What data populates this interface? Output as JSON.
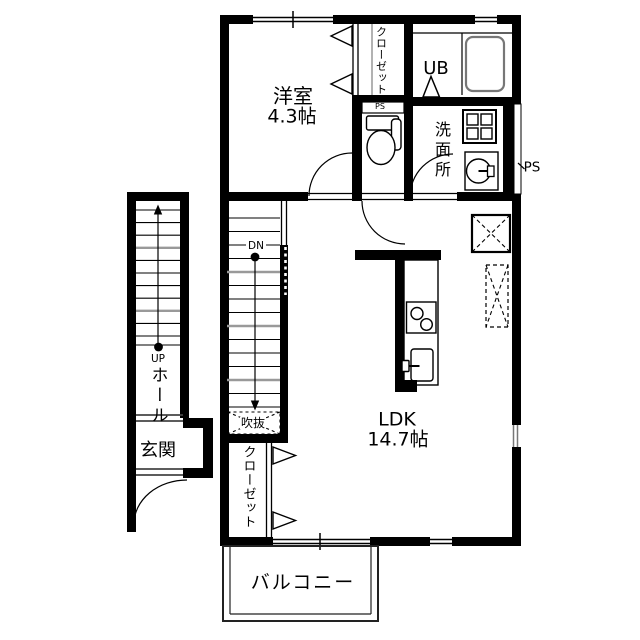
{
  "rooms": {
    "western_room": {
      "name": "洋室",
      "size": "4.3帖"
    },
    "ldk": {
      "name": "LDK",
      "size": "14.7帖"
    },
    "unit_bath": {
      "name": "UB"
    },
    "washroom": {
      "name": "洗面所"
    },
    "closet_top": {
      "name": "クローゼット"
    },
    "closet_bottom": {
      "name": "クローゼット"
    },
    "hall": {
      "name": "ホール"
    },
    "entrance": {
      "name": "玄関"
    },
    "balcony": {
      "name": "バルコニー"
    },
    "void": {
      "name": "吹抜"
    }
  },
  "annotations": {
    "pipe_space_right": "PS",
    "pipe_space_toilet": "PS",
    "stairs_up": "UP",
    "stairs_down": "DN"
  },
  "colors": {
    "wall": "#000000",
    "background": "#ffffff",
    "thin_line": "#1a1a1a",
    "tread_accent": "#999999",
    "tub_outline": "#777777"
  }
}
